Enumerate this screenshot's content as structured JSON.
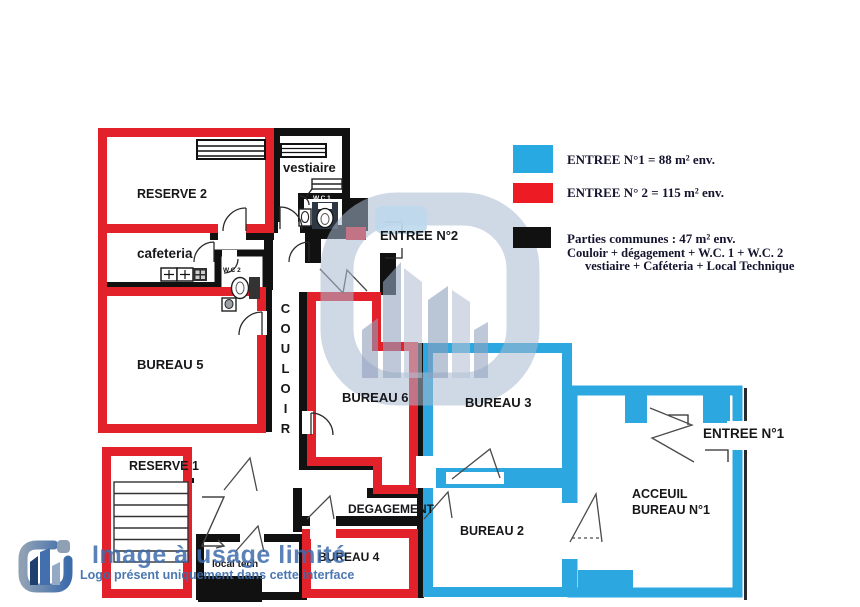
{
  "plan": {
    "rooms": {
      "reserve2": "RESERVE 2",
      "vestiaire": "vestiaire",
      "wc1": "W.C 1",
      "entree2": "ENTREE N°2",
      "cafeteria": "cafeteria",
      "wc2": "W.C 2",
      "couloir": "COULOIR",
      "bureau5": "BUREAU 5",
      "reserve1": "RESERVE 1",
      "bureau6": "BUREAU 6",
      "bureau3": "BUREAU 3",
      "degagement": "DEGAGEMENT",
      "bureau4": "BUREAU 4",
      "bureau2": "BUREAU 2",
      "acceuil_line1": "ACCEUIL",
      "acceuil_line2": "BUREAU N°1",
      "entree1": "ENTREE N°1",
      "local_tech": "local tech"
    }
  },
  "legend": {
    "entree1": {
      "swatch_color": "#29a9e1",
      "label": "ENTREE N°1 = 88 m² env."
    },
    "entree2": {
      "swatch_color": "#ed1c24",
      "label": "ENTREE N° 2 = 115 m² env."
    },
    "communes": {
      "swatch_color": "#111111",
      "label": "Parties communes : 47 m² env.",
      "detail1": "Couloir + dégagement + W.C. 1 + W.C. 2",
      "detail2": "vestiaire + Caféteria + Local Technique"
    }
  },
  "watermark": {
    "title": "Image à usage limité",
    "subtitle": "Logo présent uniquement dans cette interface"
  },
  "colors": {
    "entrance1_blue": "#29a9e1",
    "entrance2_red": "#e3212b",
    "common_black": "#111111",
    "watermark_blue": "#3d6cab"
  }
}
